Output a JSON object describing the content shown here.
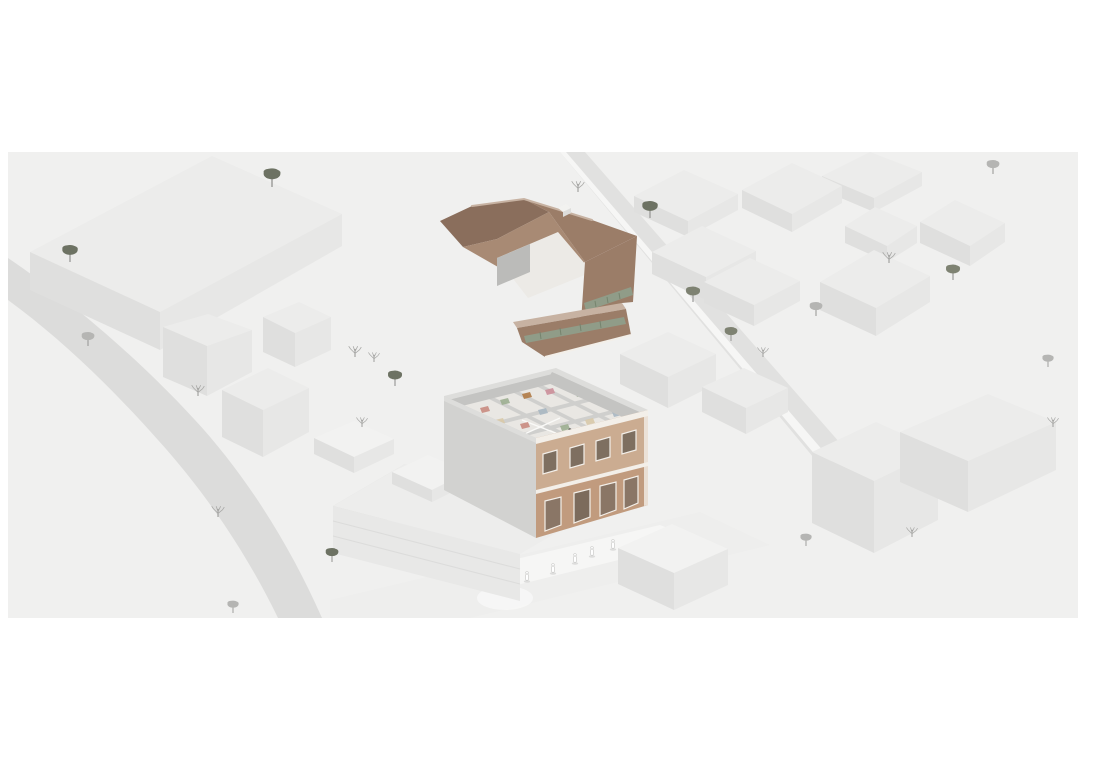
{
  "scene": {
    "type": "architectural-axonometric-site-illustration",
    "palette": {
      "bg": "#f0f0ef",
      "road": "#dcdcdb",
      "street": "#eeeeed",
      "sidewalk": "#f7f7f6",
      "block_top": "#ececeb",
      "block_top_light": "#f2f2f1",
      "block_left": "#dfdfde",
      "block_right": "#e7e7e6",
      "wall_band": "#e1e1e0",
      "wall_band_light": "#f6f6f5",
      "slab_top": "#ededec",
      "slab_face": "#e8e8e7",
      "slab_end": "#d9d9d8",
      "step_line": "#dcdcdb",
      "mb_wall_left": "#d2d2d0",
      "mb_wall_rim": "#dddddb",
      "mb_inner_wall": "#c4c4c2",
      "mb_floor": "#e9e7e3",
      "mb_partition": "#cfcfcd",
      "brick": "#c19b7e",
      "brick_light": "#cdb096",
      "window_glass": "#7e6f60",
      "trim": "#f3efe9",
      "roof_dark": "#8a6e5c",
      "roof_mid": "#9b7d68",
      "roof_light": "#a88a74",
      "roof_ridge": "#c7b2a2",
      "skylight": "#909c88",
      "skylight_dark": "#76846e",
      "courtyard_wall": "#bbbbb9",
      "courtyard_floor": "#eceae6",
      "tree_gray": "#b5b5b3",
      "tree_olive": "#7e8272",
      "tree_dark": "#6d7263",
      "tree_bare": "#a9a9a7",
      "trunk": "#9b9b99",
      "figure": "#ffffff",
      "figure_stroke": "#c6c6c4"
    },
    "trees": [
      {
        "x": 272,
        "y": 187,
        "s": 1.2,
        "variant": "round-dark"
      },
      {
        "x": 70,
        "y": 262,
        "s": 1.1,
        "variant": "round-dark"
      },
      {
        "x": 88,
        "y": 346,
        "s": 0.9,
        "variant": "round-gray"
      },
      {
        "x": 198,
        "y": 396,
        "s": 0.9,
        "variant": "bare"
      },
      {
        "x": 355,
        "y": 357,
        "s": 0.9,
        "variant": "bare"
      },
      {
        "x": 374,
        "y": 362,
        "s": 0.8,
        "variant": "bare"
      },
      {
        "x": 395,
        "y": 386,
        "s": 1.0,
        "variant": "round-dark"
      },
      {
        "x": 362,
        "y": 427,
        "s": 0.8,
        "variant": "bare"
      },
      {
        "x": 578,
        "y": 192,
        "s": 0.9,
        "variant": "bare"
      },
      {
        "x": 650,
        "y": 218,
        "s": 1.1,
        "variant": "round-dark"
      },
      {
        "x": 693,
        "y": 302,
        "s": 1.0,
        "variant": "round-olive"
      },
      {
        "x": 731,
        "y": 341,
        "s": 0.9,
        "variant": "round-olive"
      },
      {
        "x": 763,
        "y": 357,
        "s": 0.8,
        "variant": "bare"
      },
      {
        "x": 816,
        "y": 316,
        "s": 0.9,
        "variant": "round-gray"
      },
      {
        "x": 889,
        "y": 263,
        "s": 0.9,
        "variant": "bare"
      },
      {
        "x": 953,
        "y": 280,
        "s": 1.0,
        "variant": "round-olive"
      },
      {
        "x": 993,
        "y": 174,
        "s": 0.9,
        "variant": "round-gray"
      },
      {
        "x": 1048,
        "y": 367,
        "s": 0.8,
        "variant": "round-gray"
      },
      {
        "x": 1053,
        "y": 427,
        "s": 0.8,
        "variant": "bare"
      },
      {
        "x": 218,
        "y": 517,
        "s": 0.9,
        "variant": "bare"
      },
      {
        "x": 332,
        "y": 562,
        "s": 0.9,
        "variant": "round-dark"
      },
      {
        "x": 233,
        "y": 613,
        "s": 0.8,
        "variant": "round-gray"
      },
      {
        "x": 806,
        "y": 546,
        "s": 0.8,
        "variant": "round-gray"
      },
      {
        "x": 912,
        "y": 537,
        "s": 0.8,
        "variant": "bare"
      }
    ],
    "pedestrians": [
      {
        "x": 575,
        "y": 562
      },
      {
        "x": 553,
        "y": 572
      },
      {
        "x": 592,
        "y": 555
      },
      {
        "x": 527,
        "y": 580
      },
      {
        "x": 613,
        "y": 548
      }
    ],
    "plan_people": [
      {
        "x": 570,
        "y": 430
      },
      {
        "x": 521,
        "y": 272
      }
    ],
    "furniture": [
      {
        "x": 480,
        "y": 408,
        "c": "#c98b80"
      },
      {
        "x": 500,
        "y": 400,
        "c": "#9cae90"
      },
      {
        "x": 522,
        "y": 394,
        "c": "#b07a45"
      },
      {
        "x": 545,
        "y": 390,
        "c": "#cc8f9a"
      },
      {
        "x": 575,
        "y": 392,
        "c": "#9cae90"
      },
      {
        "x": 598,
        "y": 400,
        "c": "#b07a45"
      },
      {
        "x": 612,
        "y": 412,
        "c": "#a9b7c2"
      },
      {
        "x": 585,
        "y": 420,
        "c": "#d8c9a8"
      },
      {
        "x": 560,
        "y": 426,
        "c": "#9cae90"
      },
      {
        "x": 520,
        "y": 424,
        "c": "#c98b80"
      },
      {
        "x": 495,
        "y": 420,
        "c": "#d8c9a8"
      },
      {
        "x": 538,
        "y": 410,
        "c": "#a9b7c2"
      },
      {
        "x": 610,
        "y": 430,
        "c": "#b07a45"
      },
      {
        "x": 590,
        "y": 435,
        "c": "#c98b80"
      }
    ]
  }
}
